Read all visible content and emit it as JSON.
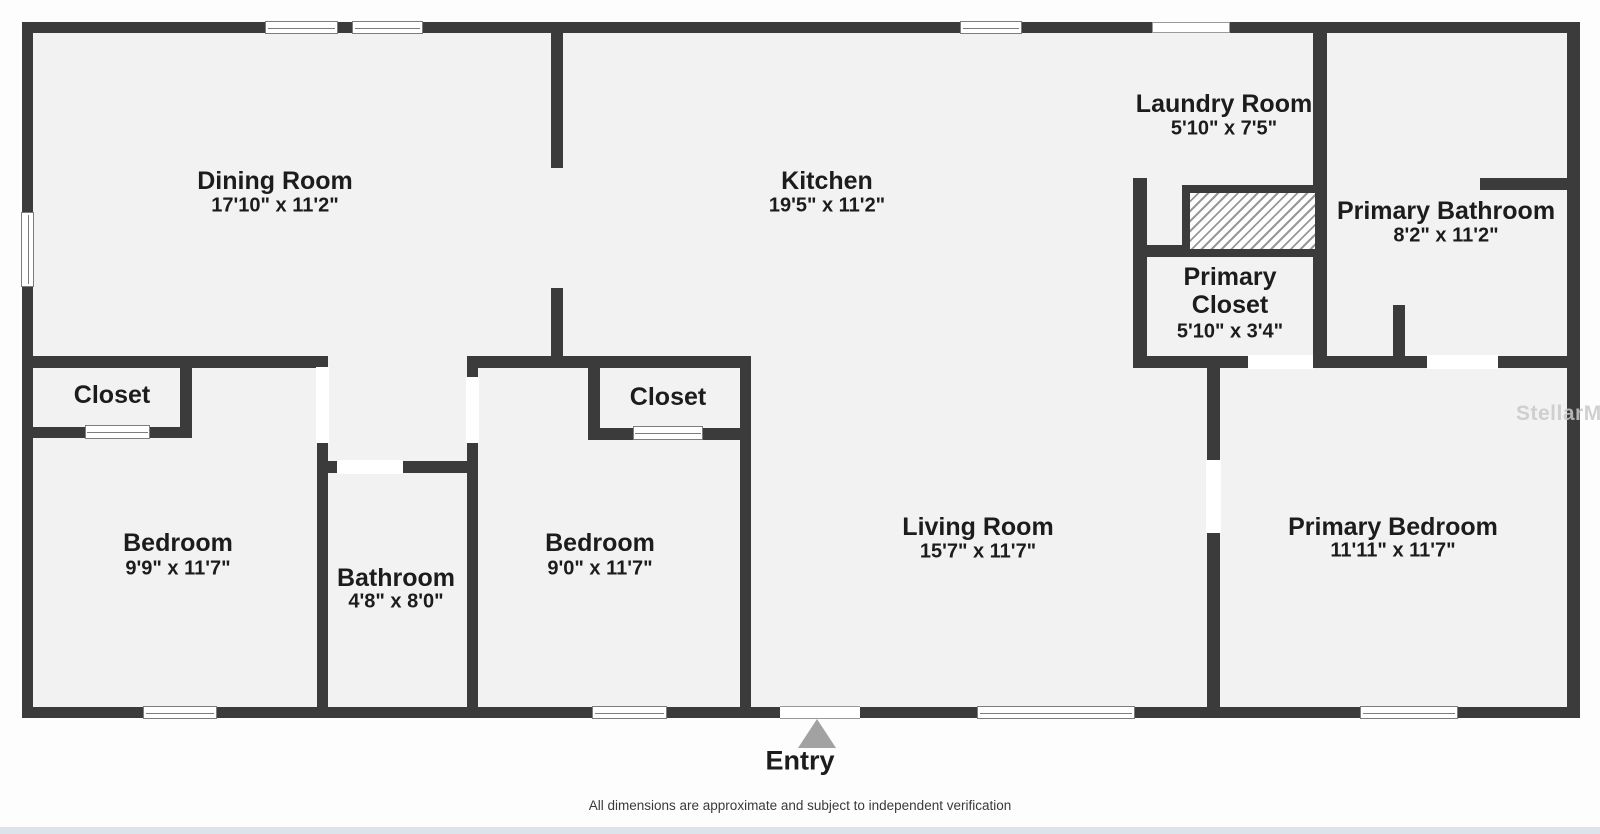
{
  "floorplan": {
    "rooms": [
      {
        "name": "Dining Room",
        "dims": "17'10\" x 11'2\""
      },
      {
        "name": "Kitchen",
        "dims": "19'5\" x 11'2\""
      },
      {
        "name": "Laundry Room",
        "dims": "5'10\" x 7'5\""
      },
      {
        "name": "Primary Bathroom",
        "dims": "8'2\" x 11'2\""
      },
      {
        "name": "Primary Closet",
        "dims": "5'10\" x 3'4\""
      },
      {
        "name": "Closet",
        "dims": ""
      },
      {
        "name": "Bedroom",
        "dims": "9'9\" x 11'7\""
      },
      {
        "name": "Bathroom",
        "dims": "4'8\" x 8'0\""
      },
      {
        "name": "Closet",
        "dims": ""
      },
      {
        "name": "Bedroom",
        "dims": "9'0\" x 11'7\""
      },
      {
        "name": "Living Room",
        "dims": "15'7\" x 11'7\""
      },
      {
        "name": "Primary Bedroom",
        "dims": "11'11\" x 11'7\""
      }
    ],
    "entry": {
      "label": "Entry"
    },
    "watermark": "StellarMLS",
    "disclaimer": "All dimensions are approximate and subject to independent verification",
    "colors": {
      "wall": "#3b3b3b",
      "floor": "#f2f2f2",
      "background": "#fdfdfd",
      "entry_arrow": "#a2a2a2",
      "watermark": "#c9c9c9",
      "footer_strip": "#dce3ea"
    }
  }
}
